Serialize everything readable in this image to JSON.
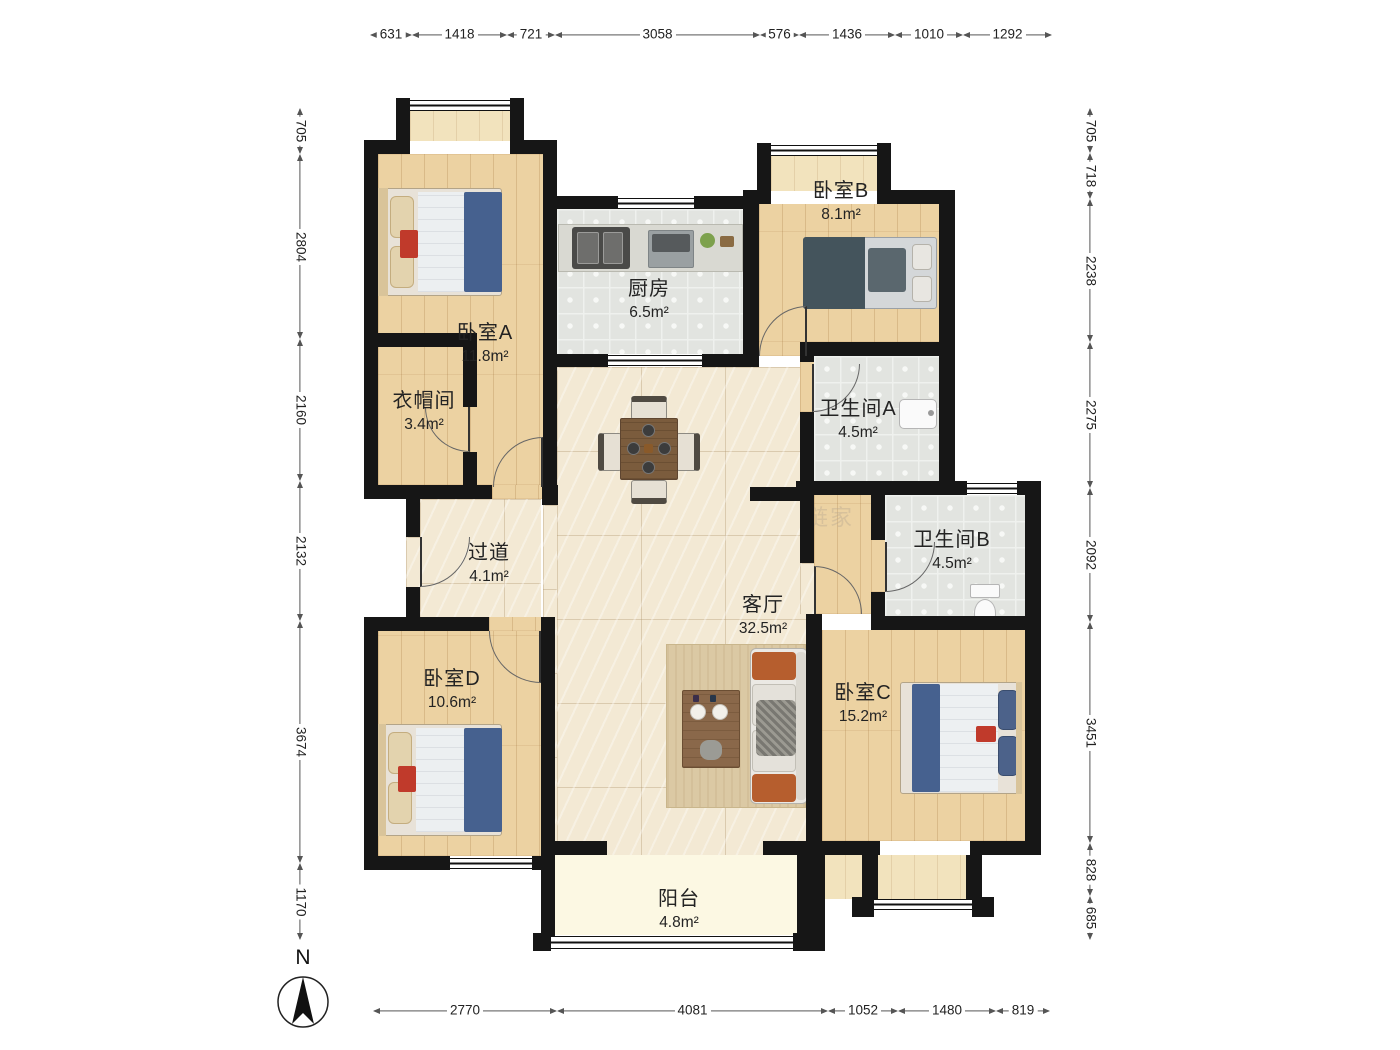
{
  "dimensions": {
    "top": [
      "631",
      "1418",
      "721",
      "3058",
      "576",
      "1436",
      "1010",
      "1292"
    ],
    "bottom": [
      "2770",
      "4081",
      "1052",
      "1480",
      "819"
    ],
    "left": [
      "705",
      "2804",
      "2160",
      "2132",
      "3674",
      "1170"
    ],
    "right": [
      "705",
      "718",
      "2238",
      "2275",
      "2092",
      "3451",
      "828",
      "685"
    ]
  },
  "rooms": {
    "bedroomA": {
      "name": "卧室A",
      "area": "11.8m²"
    },
    "bedroomB": {
      "name": "卧室B",
      "area": "8.1m²"
    },
    "bedroomC": {
      "name": "卧室C",
      "area": "15.2m²"
    },
    "bedroomD": {
      "name": "卧室D",
      "area": "10.6m²"
    },
    "kitchen": {
      "name": "厨房",
      "area": "6.5m²"
    },
    "cloakroom": {
      "name": "衣帽间",
      "area": "3.4m²"
    },
    "bathroomA": {
      "name": "卫生间A",
      "area": "4.5m²"
    },
    "bathroomB": {
      "name": "卫生间B",
      "area": "4.5m²"
    },
    "hallway": {
      "name": "过道",
      "area": "4.1m²"
    },
    "living": {
      "name": "客厅",
      "area": "32.5m²"
    },
    "balcony": {
      "name": "阳台",
      "area": "4.8m²"
    }
  },
  "compass": {
    "label": "N"
  },
  "watermark": {
    "text": "链家"
  },
  "colors": {
    "wall": "#161616",
    "wood": "#ecd2a2",
    "tile": "#e2e4e0",
    "marble": "#f3e9d4",
    "balcony": "#fcf8e3",
    "bed_blue": "#46618f",
    "sofa_orange": "#b65e2e"
  }
}
